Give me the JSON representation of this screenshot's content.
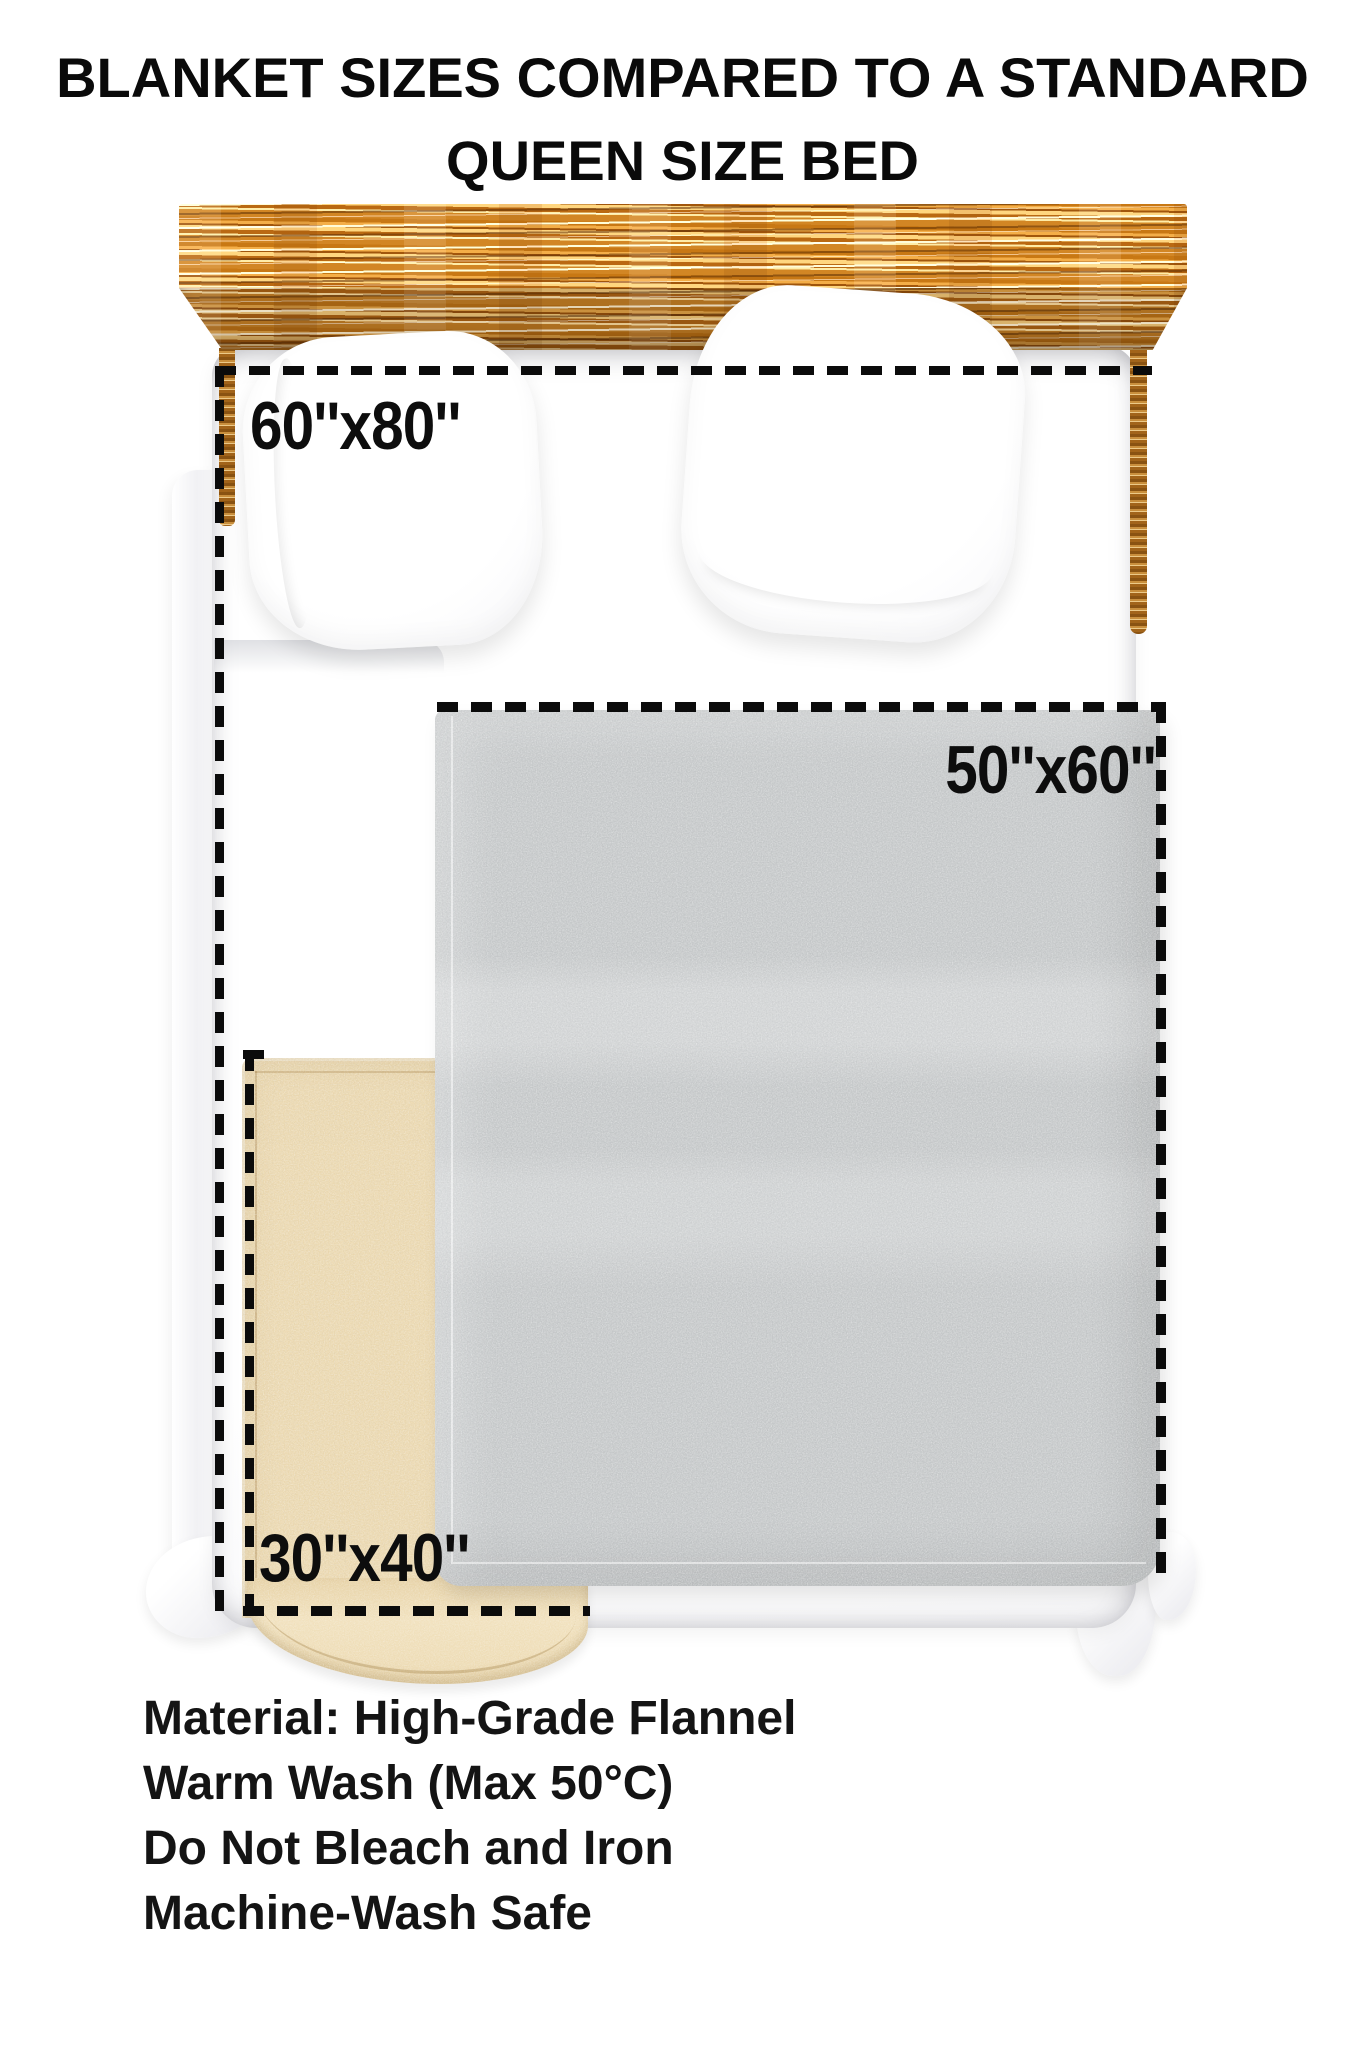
{
  "title": {
    "line1": "BLANKET SIZES COMPARED TO A STANDARD",
    "line2": "QUEEN SIZE BED"
  },
  "size_labels": {
    "large": "60''x80''",
    "medium": "50''x60''",
    "small": "30''x40''"
  },
  "care_info": {
    "line1": "Material: High-Grade Flannel",
    "line2": "Warm Wash (Max 50°C)",
    "line3": "Do Not Bleach and Iron",
    "line4": "Machine-Wash Safe"
  },
  "diagram": {
    "type": "size-comparison",
    "reference_object": "Standard Queen Size Bed",
    "blankets": [
      {
        "label": "60''x80''",
        "width_in": 60,
        "length_in": 80,
        "style": "dashed outline covering bed"
      },
      {
        "label": "50''x60''",
        "width_in": 50,
        "length_in": 60,
        "style": "gray flannel blanket"
      },
      {
        "label": "30''x40''",
        "width_in": 30,
        "length_in": 40,
        "style": "cream flannel blanket"
      }
    ]
  },
  "colors": {
    "outline_dash": "#0b0b0b",
    "wood_light": "#e7bd72",
    "wood_dark": "#8d4c0c",
    "blanket_gray": "#c6c9ca",
    "blanket_cream": "#ecd9b0",
    "sheet_white": "#ffffff",
    "background": "#ffffff",
    "text": "#0a0a0a"
  }
}
